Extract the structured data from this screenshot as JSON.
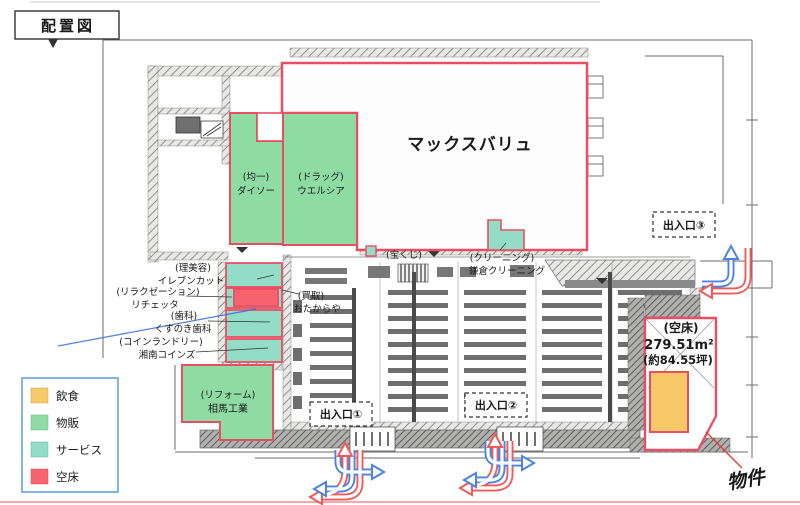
{
  "title": "配置図",
  "legend": {
    "items": [
      {
        "label": "飲食",
        "color": "#f7c968"
      },
      {
        "label": "物販",
        "color": "#8edca4"
      },
      {
        "label": "サービス",
        "color": "#93ddc6"
      },
      {
        "label": "空床",
        "color": "#f8636e"
      }
    ]
  },
  "colors": {
    "outline_red": "#e94f63",
    "arrow_red": "#f05a5a",
    "arrow_blue": "#4d82e0"
  },
  "plan": {
    "anchor": {
      "name": "マックスバリュ"
    },
    "tenants": {
      "daiso": {
        "cat": "(均一)",
        "name": "ダイソー"
      },
      "welcia": {
        "cat": "(ドラッグ)",
        "name": "ウエルシア"
      },
      "elevencut": {
        "cat": "(理美容)",
        "name": "イレブンカット"
      },
      "richetta": {
        "cat": "(リラクゼーション)",
        "name": "リチェッタ"
      },
      "kusunoki": {
        "cat": "(歯科)",
        "name": "くすのき歯科"
      },
      "shonan": {
        "cat": "(コインランドリー)",
        "name": "湘南コインズ"
      },
      "otakaraya": {
        "cat": "(買取)",
        "name": "おたからや"
      },
      "takarakuji": {
        "cat": "(宝くじ)"
      },
      "cleaning": {
        "cat": "(クリーニング)",
        "name": "鎌倉クリーニング"
      },
      "soma": {
        "cat": "(リフォーム)",
        "name": "相馬工業"
      }
    },
    "vacancy": {
      "label": "(空床)",
      "m2": "279.51m²",
      "tsubo": "(約84.55坪)"
    },
    "entrances": {
      "e1": "出入口①",
      "e2": "出入口②",
      "e3": "出入口③"
    },
    "handwritten_note": "物件"
  }
}
